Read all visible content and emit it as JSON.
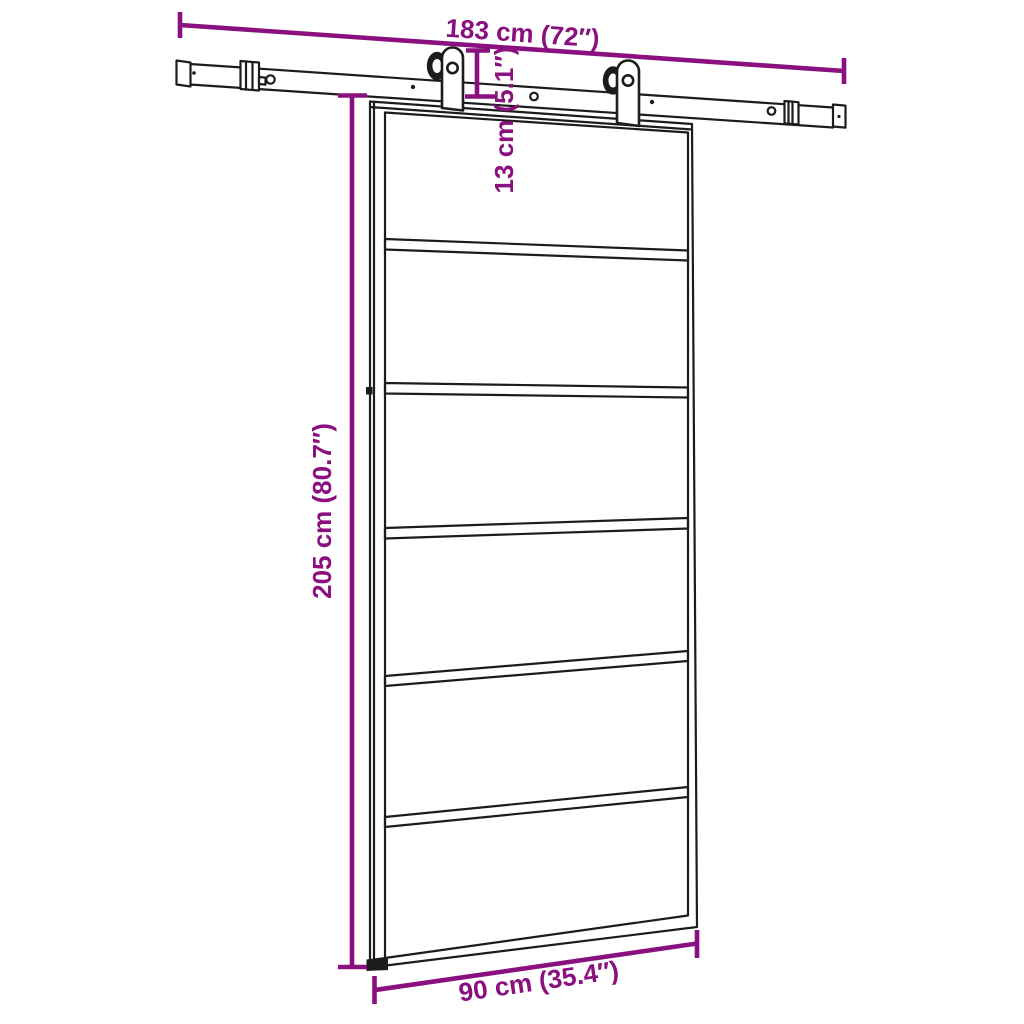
{
  "colors": {
    "dimension_accent": "#8a107f",
    "drawing_line": "#1c1c1c",
    "background": "#ffffff"
  },
  "door": {
    "panels": 6
  },
  "dimensions": {
    "rail_length": "183 cm (72″)",
    "rail_to_door_drop": "13 cm (5.1″)",
    "door_height": "205 cm (80.7″)",
    "door_width": "90 cm (35.4″)"
  }
}
